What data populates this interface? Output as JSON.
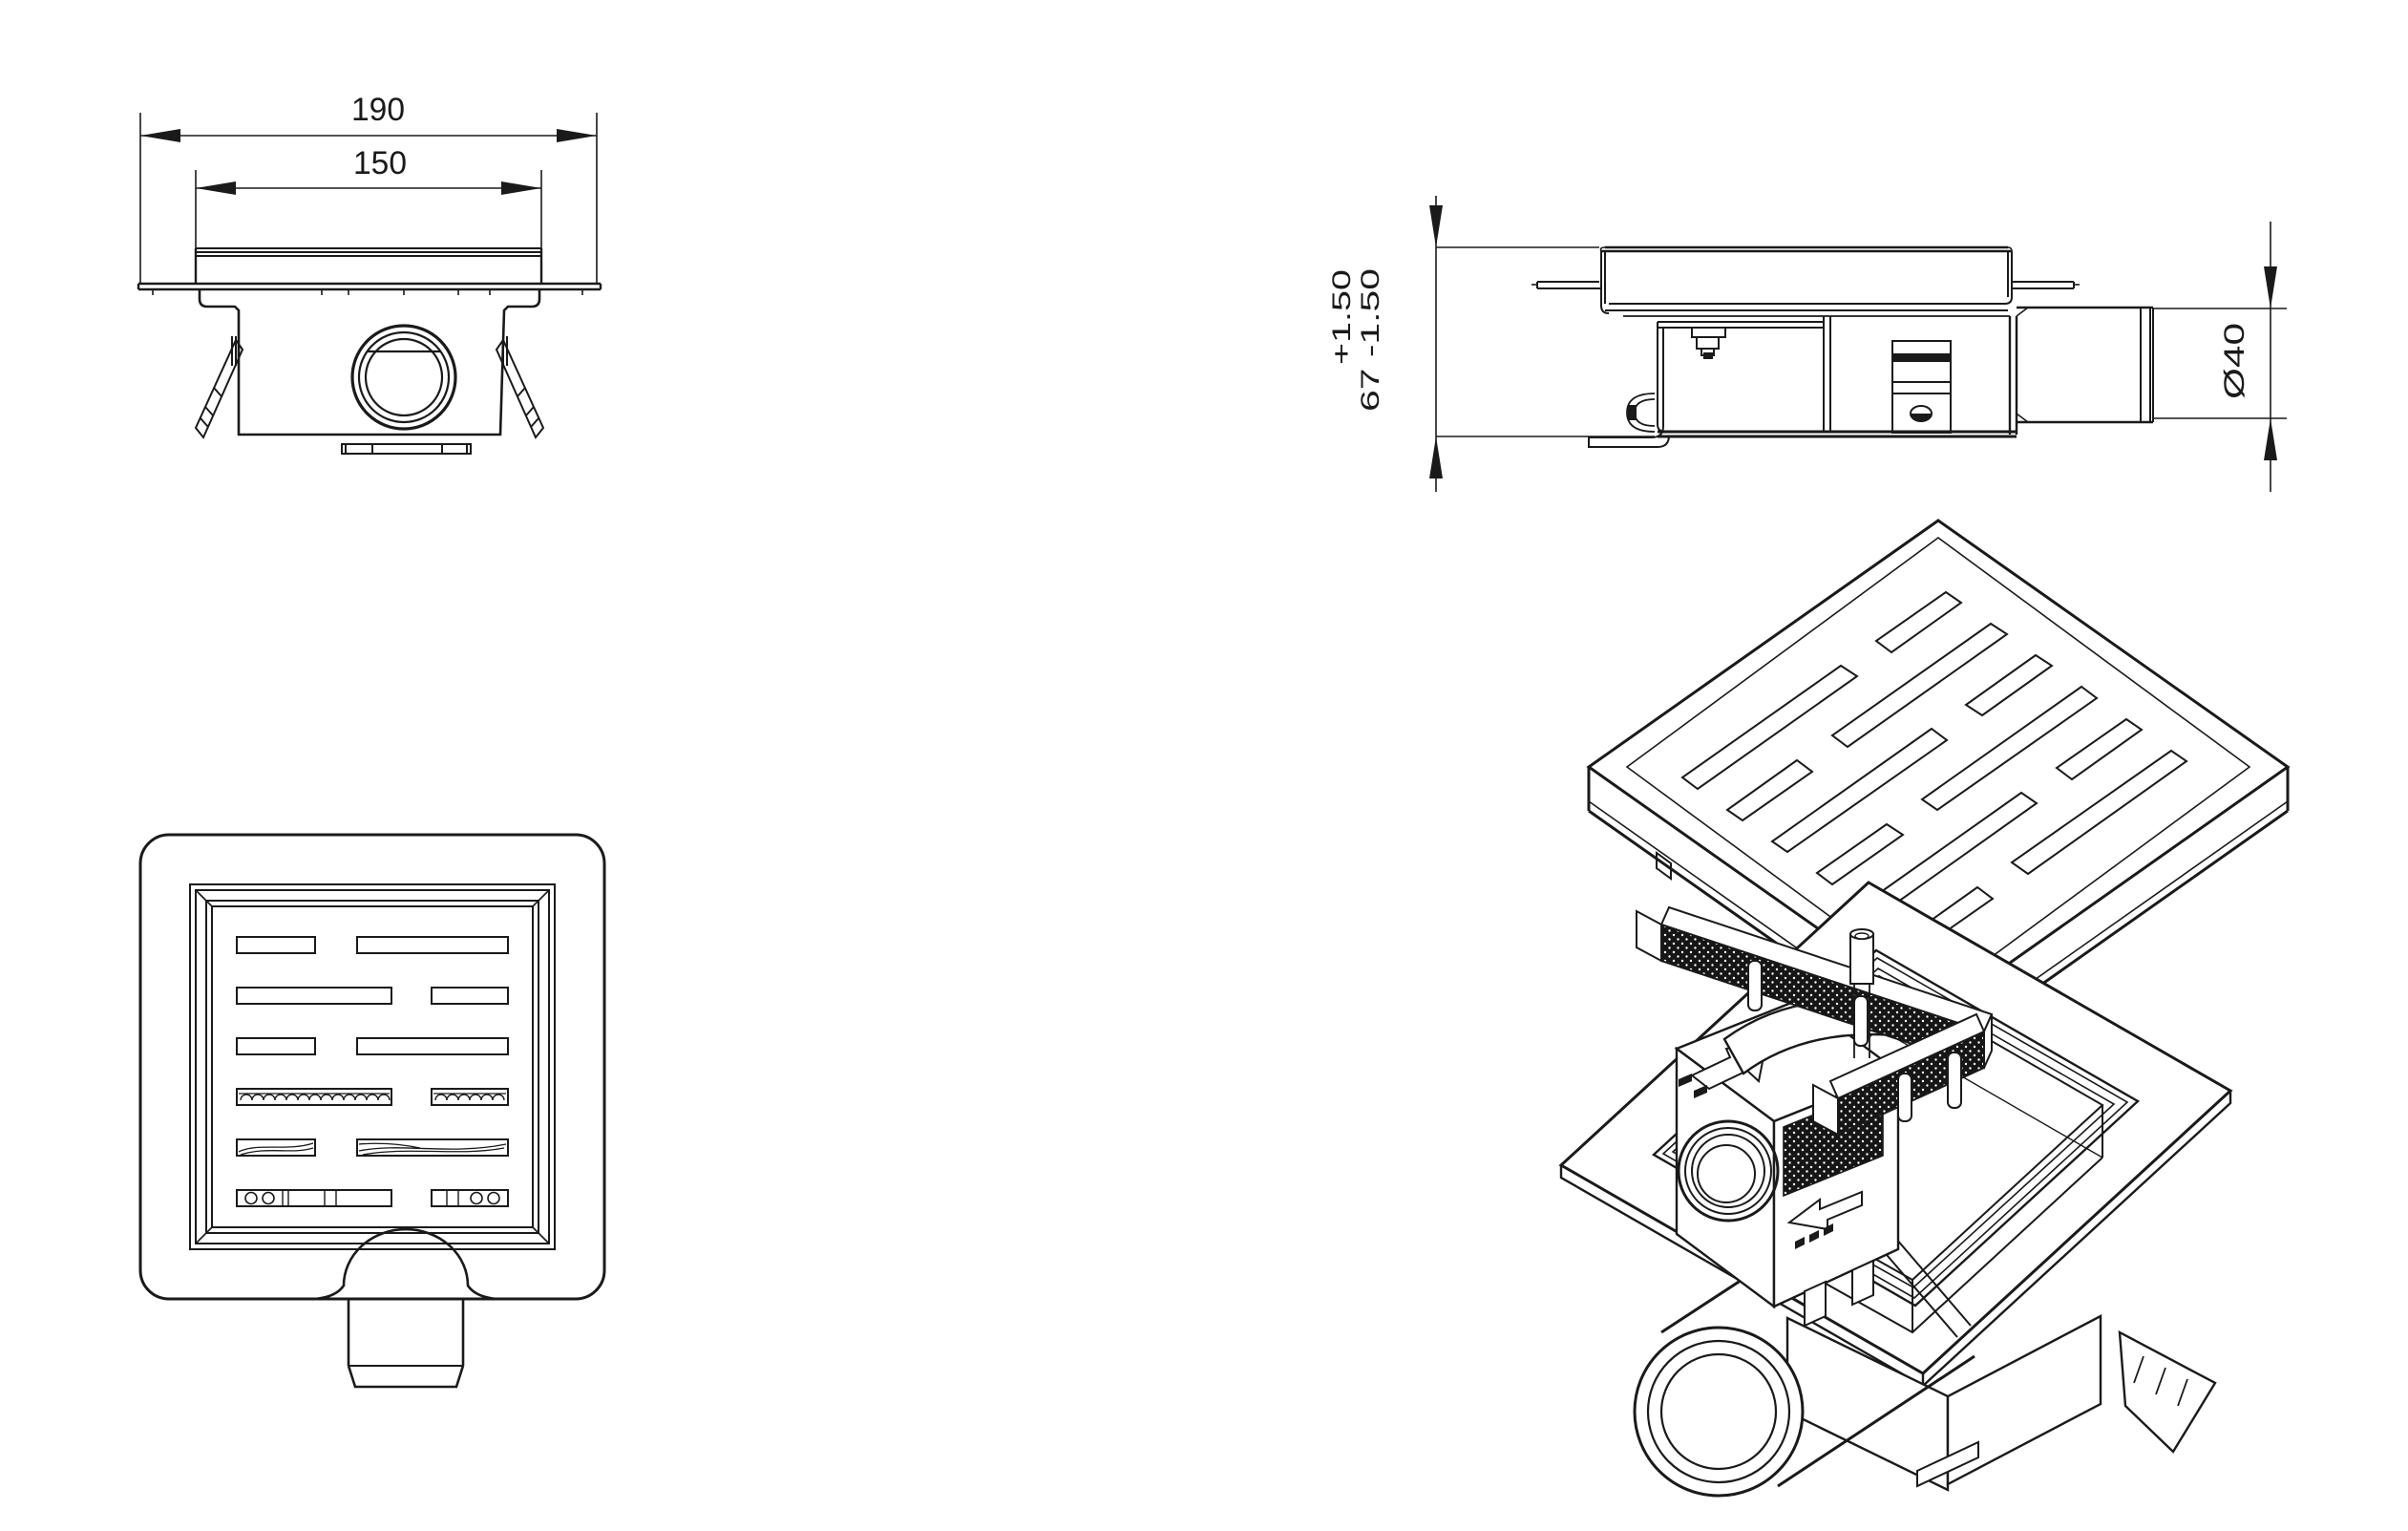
{
  "page": {
    "title": "floor-drain-technical-drawing",
    "background": "#ffffff",
    "line_color": "#1a1a1a"
  },
  "views": {
    "front": {
      "label": "front-section-view",
      "dims": {
        "width_outer": "190",
        "width_inner": "150"
      }
    },
    "side": {
      "label": "side-section-view",
      "dims": {
        "tol_plus": "+1.50",
        "height_with_tol": "67 -1.50",
        "pipe_dia": "Ø40"
      }
    },
    "top": {
      "label": "top-plan-view"
    },
    "iso": {
      "label": "isometric-exploded-view"
    }
  }
}
